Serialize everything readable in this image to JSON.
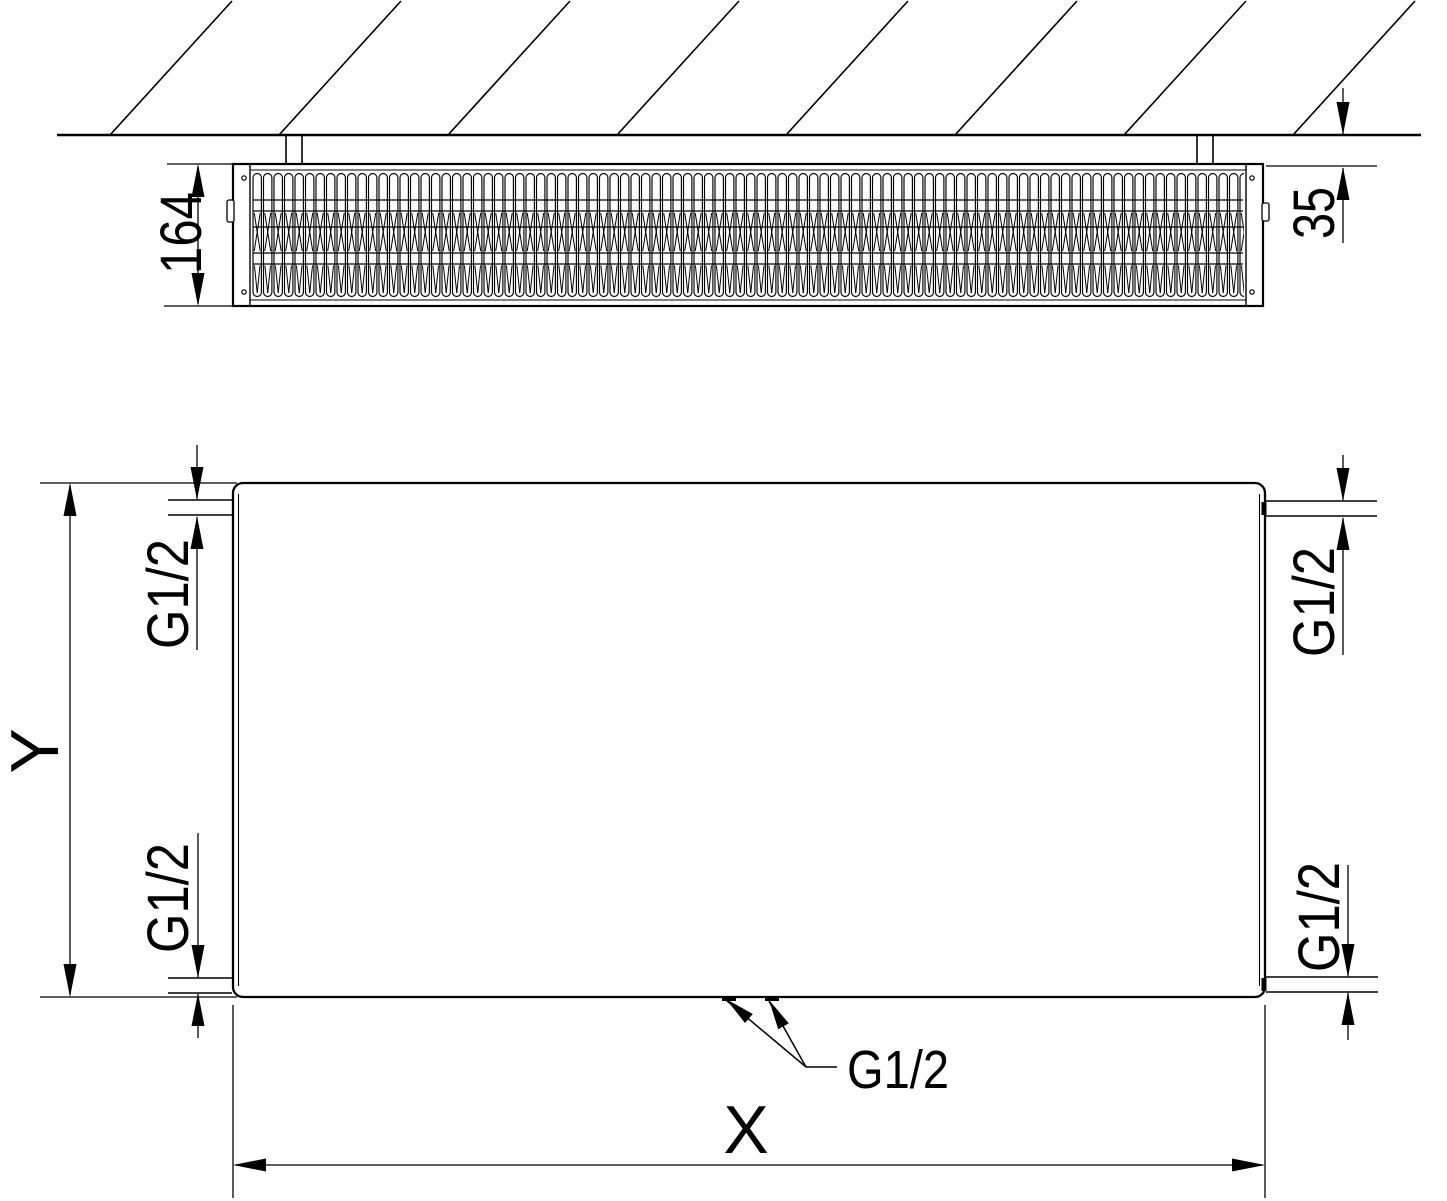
{
  "colors": {
    "line": "#000000",
    "background": "#ffffff"
  },
  "labels": {
    "depth": "164",
    "wall_distance": "35",
    "height_axis": "Y",
    "width_axis": "X",
    "connection_top_left": "G1/2",
    "connection_bottom_left": "G1/2",
    "connection_top_right": "G1/2",
    "connection_bottom_right": "G1/2",
    "connection_bottom_center": "G1/2"
  }
}
